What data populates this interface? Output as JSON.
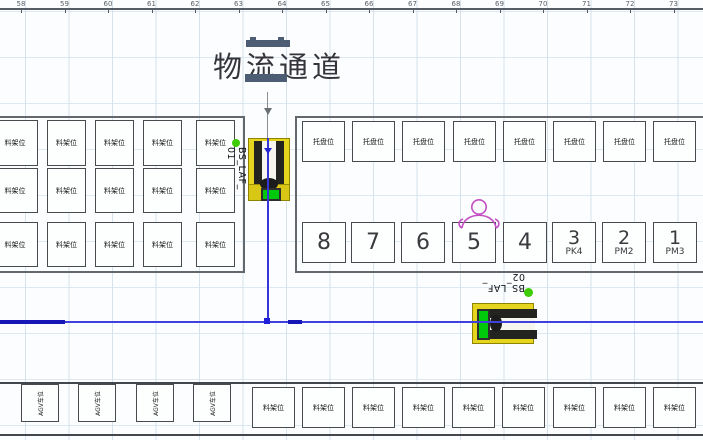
{
  "title": "物流通道",
  "ruler_numbers": [
    "58",
    "59",
    "60",
    "61",
    "62",
    "63",
    "64",
    "65",
    "66",
    "67",
    "68",
    "69",
    "70",
    "71",
    "72",
    "73"
  ],
  "slots": {
    "rack_label": "料架位",
    "pallet_label": "托盘位",
    "agv_label": "AGV车位",
    "station_numbers": [
      "8",
      "7",
      "6",
      "5",
      "4",
      "3",
      "2",
      "1"
    ],
    "station_subs": [
      "",
      "",
      "",
      "",
      "",
      "PK4",
      "PM2",
      "PM3"
    ]
  },
  "machines": [
    {
      "name": "BS_LAF_",
      "number": "01"
    },
    {
      "name": "BS_LAF_",
      "number": "02"
    }
  ],
  "colors": {
    "machine_yellow": "#e6d51f",
    "screen_green": "#00c80a",
    "route_blue": "#3535d8",
    "marker_green": "#3dcc05",
    "operator_magenta": "#c44fc4"
  }
}
